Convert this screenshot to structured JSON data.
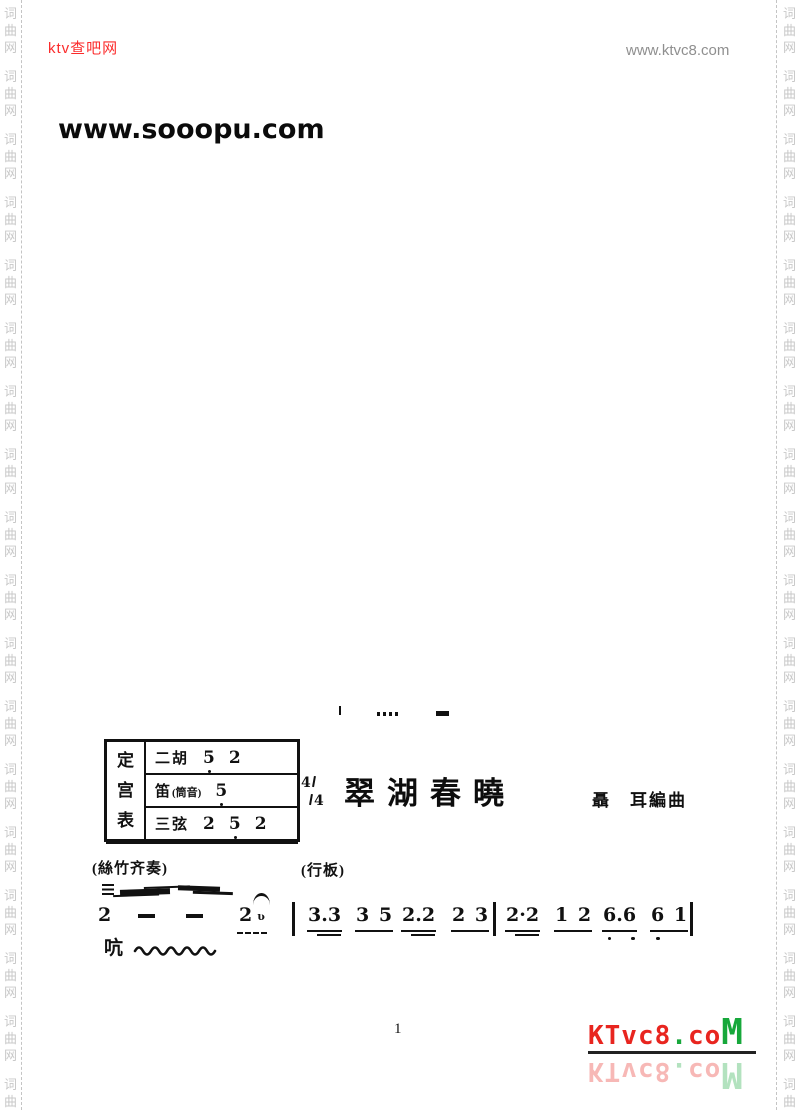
{
  "header": {
    "site_left": "ktv查吧网",
    "site_right": "www.ktvc8.com"
  },
  "watermark": "www.sooopu.com",
  "margins": {
    "vertical_text": "词曲网",
    "chars": [
      "词",
      "曲",
      "网"
    ],
    "repeat_groups": 18
  },
  "tuning_table": {
    "side_label": "定宫表",
    "rows": [
      {
        "name": "二胡",
        "paren": "",
        "notes": [
          {
            "n": "5",
            "dot_below": true
          },
          {
            "n": "2",
            "dot_below": false
          }
        ]
      },
      {
        "name": "笛",
        "paren": "(筒音)",
        "notes": [
          {
            "n": "5",
            "dot_below": true
          }
        ]
      },
      {
        "name": "三弦",
        "paren": "",
        "notes": [
          {
            "n": "2",
            "dot_below": false
          },
          {
            "n": "5",
            "dot_below": true
          },
          {
            "n": "2",
            "dot_below": false
          }
        ]
      }
    ]
  },
  "score": {
    "time_signature": {
      "numerator": "4",
      "denominator": "4",
      "display": "4/4"
    },
    "title": "翠湖春曉",
    "composer": "聶　耳編曲",
    "ensemble_label": "(絲竹齐奏)",
    "tempo_label": "(行板)",
    "lyric": "吭",
    "music_line": {
      "tokens": [
        {
          "type": "note",
          "text": "2"
        },
        {
          "type": "dash"
        },
        {
          "type": "dash"
        },
        {
          "type": "note",
          "text": "2",
          "fermata": true,
          "grace_mark": "ʋ",
          "dashed_underline": true
        },
        {
          "type": "bar"
        },
        {
          "type": "group",
          "text": "3.3",
          "underlines": 2
        },
        {
          "type": "group",
          "text": "3 5",
          "underlines": 1
        },
        {
          "type": "group",
          "text": "2.2",
          "underlines": 2
        },
        {
          "type": "group",
          "text": "2 3",
          "underlines": 1
        },
        {
          "type": "bar"
        },
        {
          "type": "group",
          "text": "2·2",
          "underlines": 2
        },
        {
          "type": "group",
          "text": "1 2",
          "underlines": 1
        },
        {
          "type": "group",
          "text": "6.6",
          "underlines": 1,
          "dots_below": [
            0,
            2
          ]
        },
        {
          "type": "group",
          "text": "6 1",
          "underlines": 1,
          "dots_below": [
            0
          ]
        },
        {
          "type": "bar"
        }
      ]
    }
  },
  "footer": {
    "page_number": "1"
  },
  "logo": {
    "segments": [
      {
        "text": "KTvc8",
        "color": "#e8251f",
        "large": false
      },
      {
        "text": ".",
        "color": "#17a83b",
        "large": false
      },
      {
        "text": "co",
        "color": "#e8251f",
        "large": false
      },
      {
        "text": "M",
        "color": "#17a83b",
        "large": true
      }
    ]
  },
  "colors": {
    "header_red": "#fb2b2b",
    "header_gray": "#8f8f8f",
    "margin_gray": "#c8c8c8",
    "logo_red": "#e8251f",
    "logo_green": "#17a83b",
    "ink": "#111111"
  }
}
